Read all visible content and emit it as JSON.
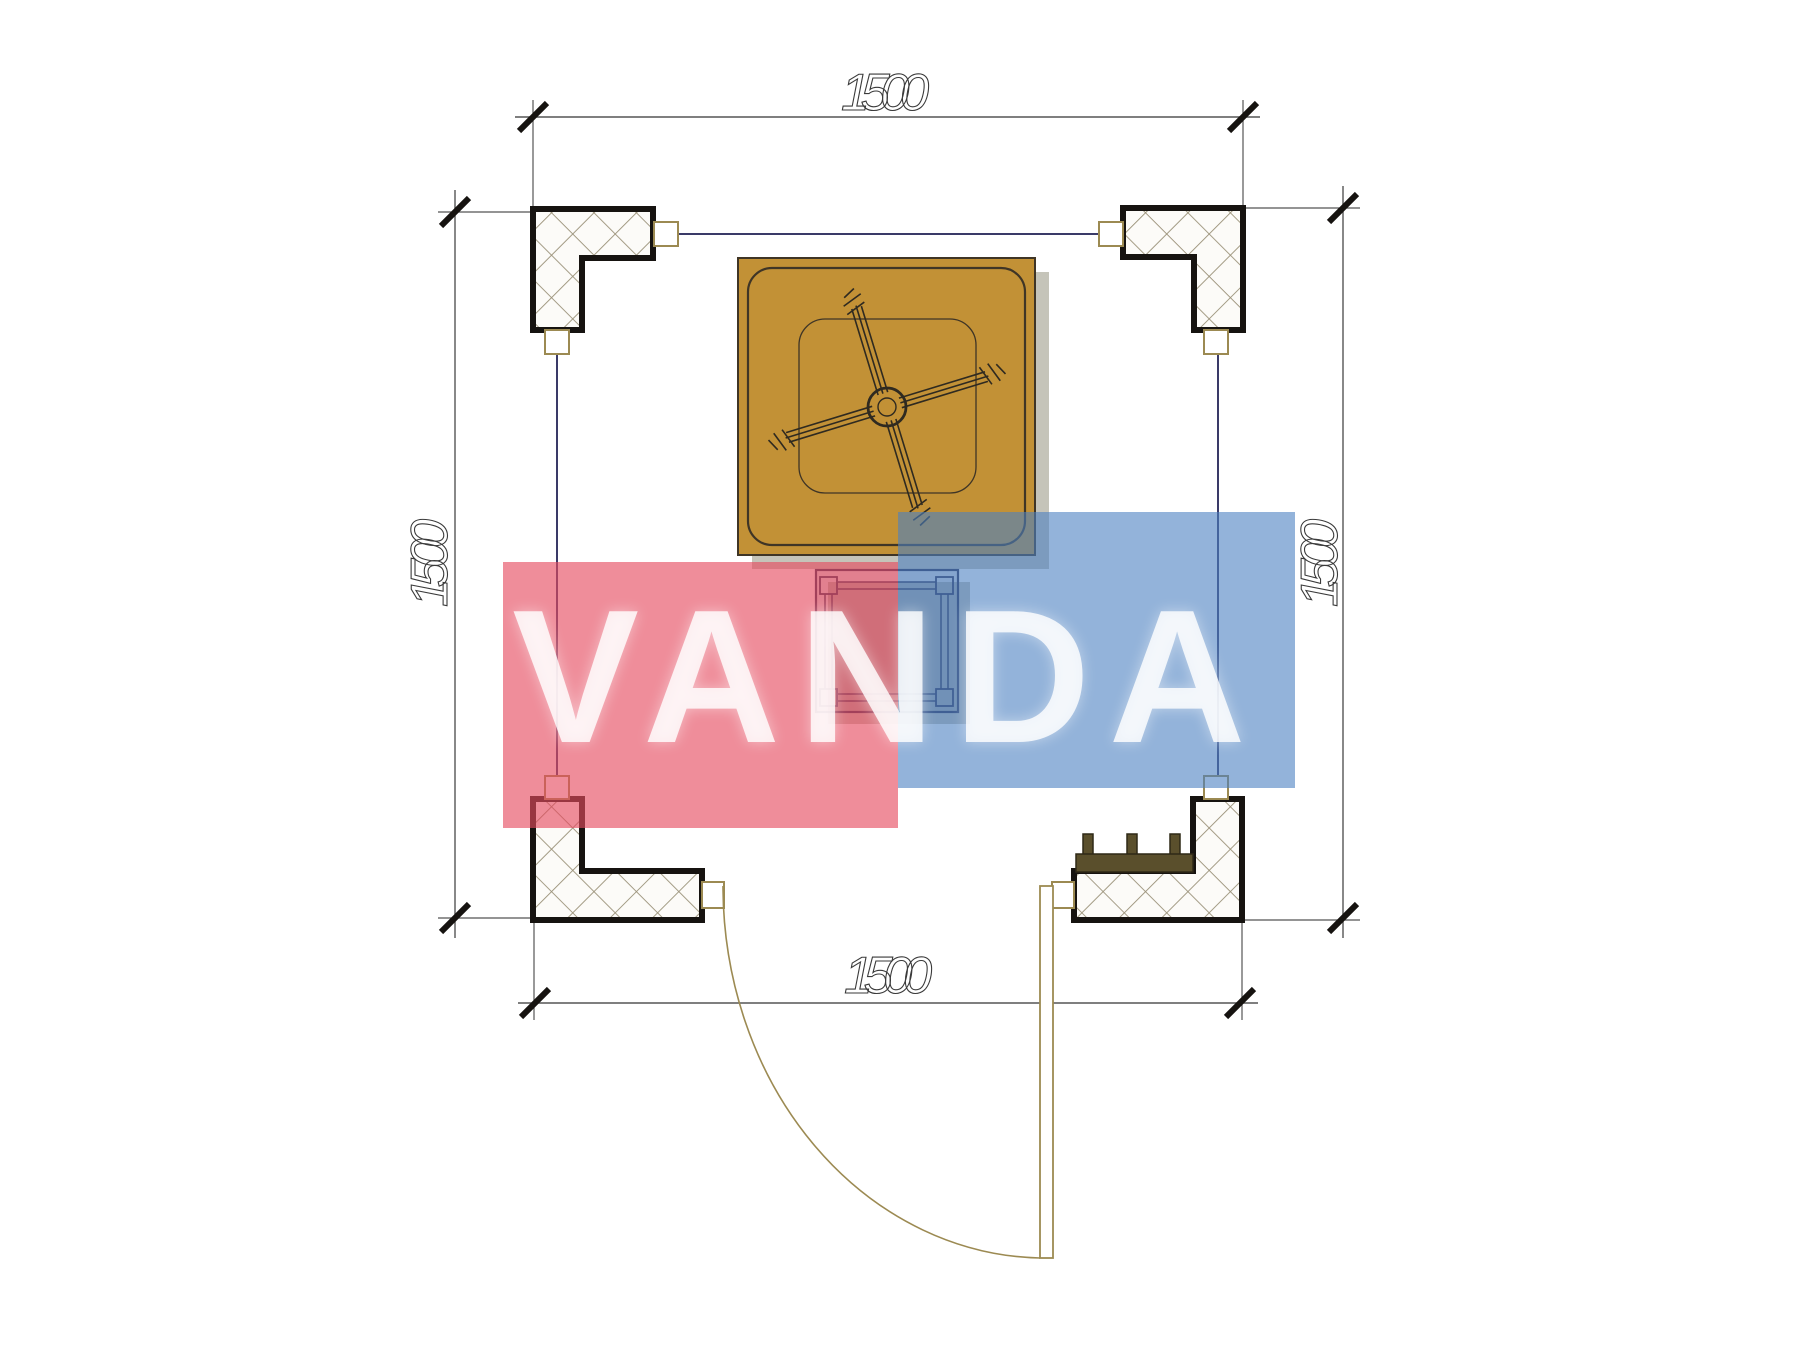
{
  "drawing": {
    "type": "architectural-floor-plan",
    "dimension_labels": {
      "top": "1500",
      "bottom": "1500",
      "left": "1500",
      "right": "1500"
    },
    "watermark": {
      "text": "VANDA"
    },
    "elements": {
      "columns": "four-hatched-corner-columns",
      "canopy": "square-canopy-with-four-blade-fan",
      "table": "square-table-with-four-legs",
      "bench": "bench-with-three-posts",
      "door": "door-leaf-with-swing-arc"
    },
    "colors": {
      "canopy_fill": "#C29136",
      "canopy_outline": "#3F3526",
      "fan_line": "#2F2A20",
      "column_outline": "#161310",
      "hatch_line": "#9A9178",
      "hatch_fill": "#FCFBF8",
      "wall_line": "#3A3A68",
      "fitting_outline": "#9C8A52",
      "bench_fill": "#5A4F2C",
      "bench_outline": "#2E2817",
      "table_line": "#2E2E52",
      "table_fill": "rgba(35,35,75,0.16)",
      "shadow": "rgba(150,148,128,0.55)",
      "dimension_line": "#555555",
      "dimension_text": "#3A3A3A",
      "tick_color": "#161310",
      "door_line": "#9C8A52",
      "wm_red": "rgba(230,75,95,0.63)",
      "wm_blue": "rgba(75,128,193,0.60)",
      "wm_text": "rgba(255,255,255,0.82)"
    }
  }
}
